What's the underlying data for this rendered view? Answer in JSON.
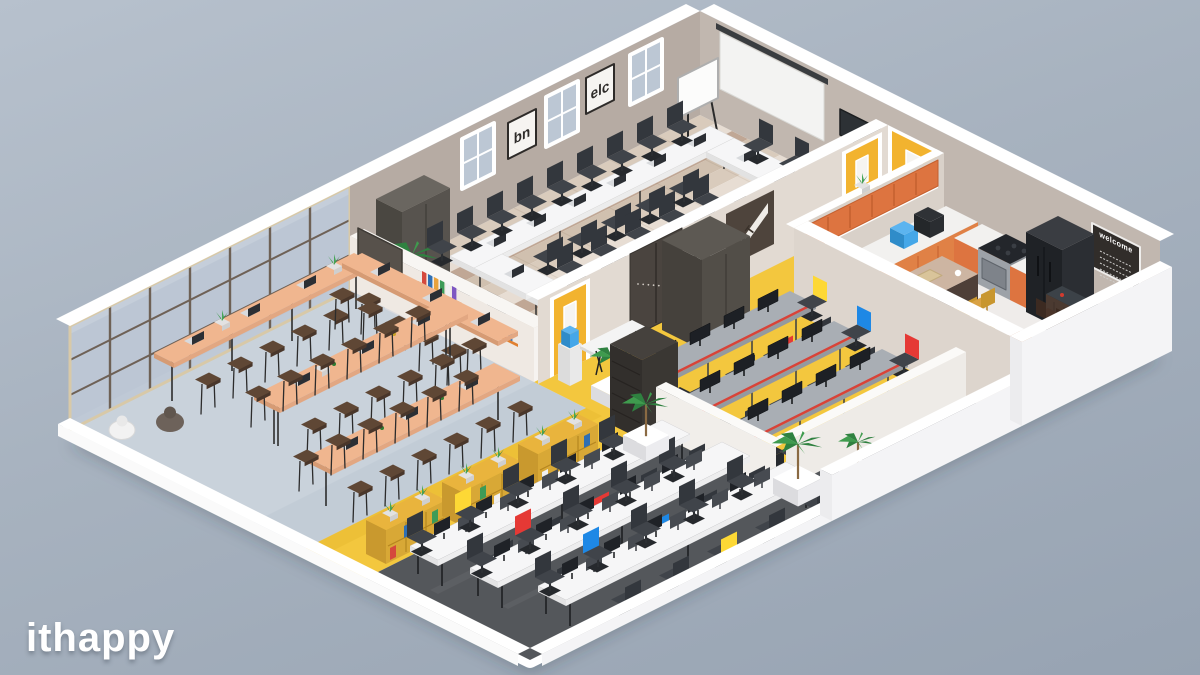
{
  "watermark": "ithappy",
  "wall_art": {
    "poster": "ART",
    "welcome_board": "welcome",
    "frame_left": "bn",
    "frame_right": "elc"
  },
  "zones": {
    "meeting_room": "meeting-room",
    "lounge": "lounge-cafe",
    "corridor": "corridor",
    "workstations": "workstation-area",
    "open_office": "open-office",
    "kitchen": "kitchen-dining"
  },
  "colors": {
    "background_top": "#b7c1cd",
    "background_bottom": "#97a3b2",
    "floor_lounge": "#c9d2db",
    "floor_yellow": "#f3c73e",
    "floor_dark": "#54575b",
    "floor_kitchen": "#efecea",
    "parquet_1": "#d9cbbc",
    "parquet_2": "#e7ddd3",
    "parquet_3": "#c0a795",
    "parquet_4": "#d0c0af",
    "wall": "#b6aba3",
    "wall_right": "#c1b7af",
    "wall_light": "#e2dad2",
    "wall_white": "#f4f1ee",
    "glass": "#bcc7d4",
    "frame_bronze": "#6e6156",
    "door_yellow": "#f2b32f",
    "kitchen_orange": "#dd7440",
    "shelf_yellow": "#e9b43d",
    "table_peach": "#f0b68f",
    "desk_white": "#f6f6f7",
    "desk_gray": "#a9aeb4",
    "trim_red": "#d84339",
    "chair_dark": "#3d4147",
    "chair_red": "#e53935",
    "chair_yellow": "#fdd835",
    "chair_blue": "#1e88e5",
    "wood": "#d9a245",
    "dark_furniture": "#4a443f",
    "fridge": "#26292d",
    "tv": "#2d3135",
    "screen_white": "#f3f3f2",
    "plant_green": "#3f9b4e",
    "pot_white": "#ffffff",
    "water_blue": "#45a7e8",
    "bar_dark": "#4b3a31",
    "white": "#ffffff"
  }
}
